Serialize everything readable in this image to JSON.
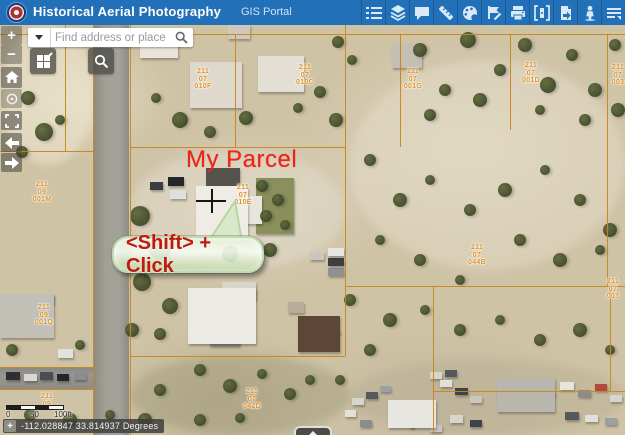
{
  "header": {
    "title": "Historical Aerial Photography",
    "portal_label": "GIS Portal",
    "background_color": "#2271b8",
    "toolbar_icons": [
      "legend",
      "layers",
      "comment",
      "measure",
      "draw",
      "edit",
      "print",
      "swipe",
      "export",
      "streetview",
      "more-menu"
    ]
  },
  "search": {
    "placeholder": "Find address or place"
  },
  "map_overlay": {
    "parcel_annotation": "My Parcel",
    "callout_text": "<Shift> + Click",
    "annotation_color": "#ea2417",
    "parcel_line_color": "#c9861a",
    "parcel_label_color": "#e09122"
  },
  "parcel_labels": [
    {
      "x": 42,
      "y": 156,
      "lines": [
        "211",
        "09",
        "001M"
      ]
    },
    {
      "x": 203,
      "y": 43,
      "lines": [
        "211",
        "07",
        "010F"
      ]
    },
    {
      "x": 305,
      "y": 39,
      "lines": [
        "211",
        "07",
        "010C"
      ]
    },
    {
      "x": 413,
      "y": 43,
      "lines": [
        "211",
        "07",
        "001G"
      ]
    },
    {
      "x": 531,
      "y": 37,
      "lines": [
        "211",
        "07",
        "001D"
      ]
    },
    {
      "x": 618,
      "y": 39,
      "lines": [
        "211",
        "07",
        "003"
      ]
    },
    {
      "x": 243,
      "y": 159,
      "lines": [
        "211",
        "07",
        "010E"
      ]
    },
    {
      "x": 477,
      "y": 219,
      "lines": [
        "211",
        "07",
        "044B"
      ]
    },
    {
      "x": 613,
      "y": 253,
      "lines": [
        "211",
        "07",
        "003"
      ]
    },
    {
      "x": 44,
      "y": 279,
      "lines": [
        "211",
        "09",
        "001Q"
      ]
    },
    {
      "x": 252,
      "y": 363,
      "lines": [
        "211",
        "07",
        "042D"
      ]
    },
    {
      "x": 47,
      "y": 368,
      "lines": [
        "211",
        "09"
      ]
    }
  ],
  "scalebar": {
    "labels": [
      "0",
      "50",
      "100ft"
    ]
  },
  "coordinates": {
    "value": "-112.028847 33.814937 Degrees"
  }
}
